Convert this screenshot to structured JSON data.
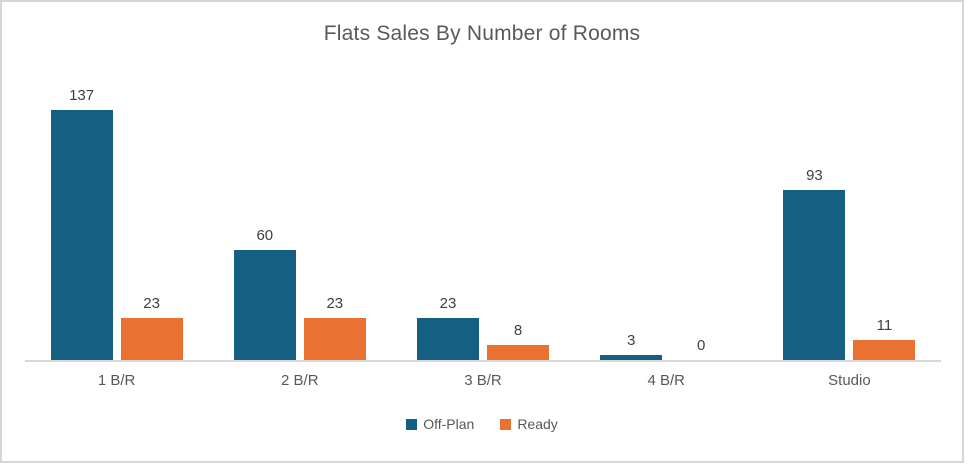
{
  "chart_data": {
    "type": "bar",
    "title": "Flats Sales By Number of Rooms",
    "categories": [
      "1 B/R",
      "2 B/R",
      "3 B/R",
      "4 B/R",
      "Studio"
    ],
    "series": [
      {
        "name": "Off-Plan",
        "color": "#156082",
        "values": [
          137,
          60,
          23,
          3,
          93
        ]
      },
      {
        "name": "Ready",
        "color": "#E97132",
        "values": [
          23,
          23,
          8,
          0,
          11
        ]
      }
    ],
    "xlabel": "",
    "ylabel": "",
    "ylim": [
      0,
      160
    ],
    "grid": false,
    "legend_position": "bottom",
    "data_labels": true
  },
  "colors": {
    "title_text": "#595959",
    "data_label_text": "#404040",
    "category_text": "#595959",
    "legend_text": "#595959",
    "axis_line": "#d9d9d9",
    "chart_border": "#d6d6d6",
    "background": "#ffffff"
  }
}
